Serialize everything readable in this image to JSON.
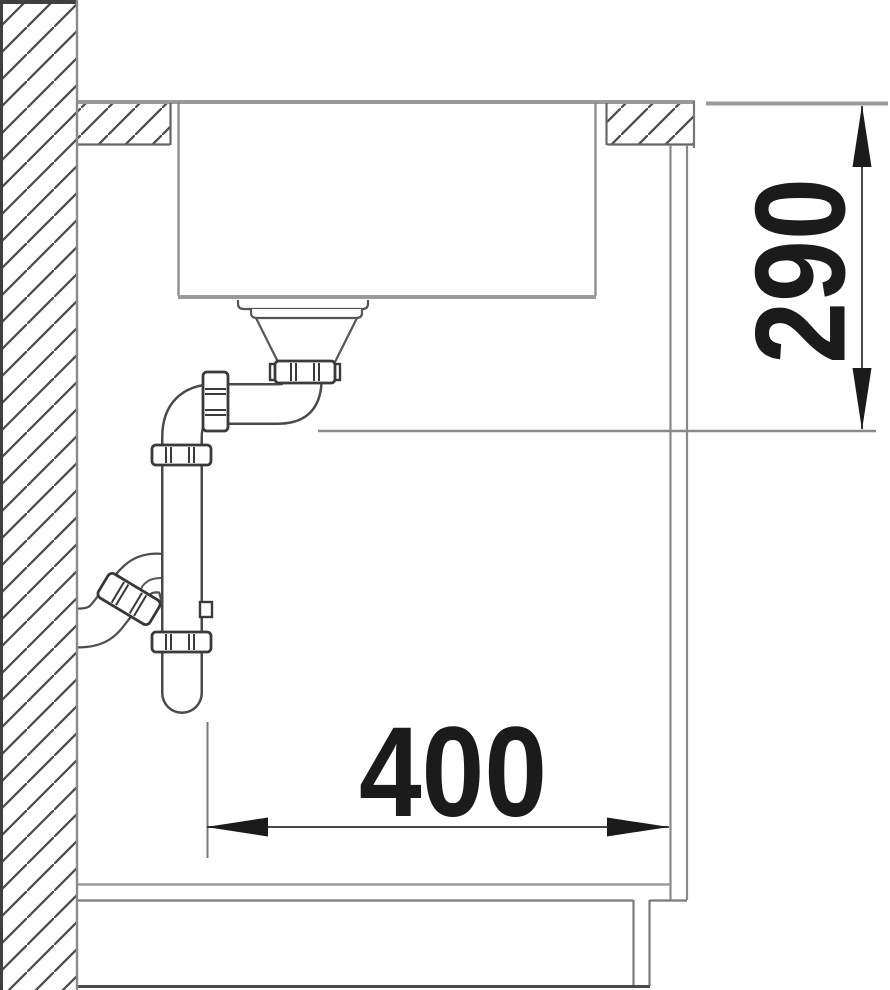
{
  "drawing": {
    "kind": "sink-installation-cross-section",
    "dimensions": {
      "vertical": {
        "value": "290",
        "orientation": "vertical"
      },
      "horizontal": {
        "value": "400",
        "orientation": "horizontal"
      }
    },
    "colors": {
      "dimension_text": "#1b1b1b",
      "arrow": "#1b1b1b",
      "line_thick_gray": "#9a9a9a",
      "line_medium": "#555555",
      "hatch": "#4d4d4d",
      "background": "#ffffff"
    }
  }
}
